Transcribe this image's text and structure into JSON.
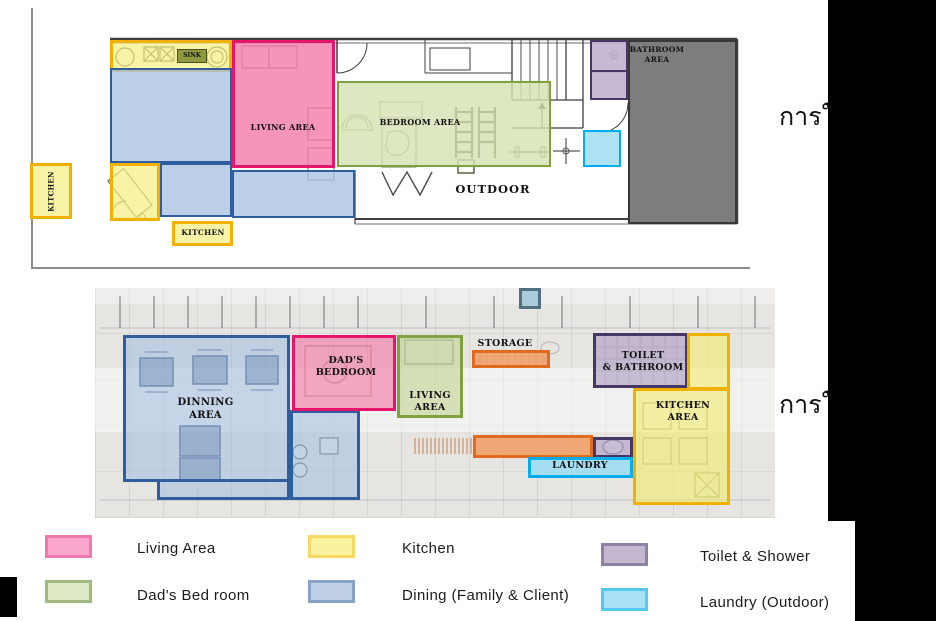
{
  "captions": {
    "right_top": "การใช",
    "right_bottom": "การใช"
  },
  "top_plan": {
    "labels": {
      "sink": "SINK",
      "living": "LIVING AREA",
      "bedroom": "BEDROOM AREA",
      "outdoor": "OUTDOOR",
      "bathroom": "BATHROOM\nAREA",
      "kitchen_left": "KITCHEN",
      "kitchen_bottom": "KITCHEN"
    }
  },
  "bottom_plan": {
    "labels": {
      "dinning": "DINNING\nAREA",
      "dads_bedroom": "DAD'S\nBEDROOM",
      "living": "LIVING\nAREA",
      "storage": "STORAGE",
      "toilet": "TOILET\n& BATHROOM",
      "kitchen": "KITCHEN\nAREA",
      "laundry": "LAUNDRY"
    }
  },
  "legend": {
    "items": [
      {
        "label": "Living Area",
        "fill": "#FBA6CC",
        "border": "#F277AE"
      },
      {
        "label": "Kitchen",
        "fill": "#FAF29E",
        "border": "#F5D960"
      },
      {
        "label": "Toilet & Shower",
        "fill": "#C4B7D2",
        "border": "#8E81A6"
      },
      {
        "label": "Dad's Bed room",
        "fill": "#DEE8C6",
        "border": "#9FB97E"
      },
      {
        "label": "Dining (Family & Client)",
        "fill": "#BECFE6",
        "border": "#87A3C6"
      },
      {
        "label": "Laundry (Outdoor)",
        "fill": "#A9E2F6",
        "border": "#55C8F0"
      }
    ]
  },
  "colors": {
    "living_pink_border": "#E8156D",
    "kitchen_yellow_border": "#F2B100",
    "bedroom_green_border": "#7FA23E",
    "dining_blue_border": "#2E5E9E",
    "toilet_purple_border": "#463864",
    "laundry_cyan_border": "#00AEEF",
    "storage_orange_border": "#E06A1F",
    "bathroom_gray_fill": "#7D7D7D",
    "background_mask": "#000000"
  }
}
